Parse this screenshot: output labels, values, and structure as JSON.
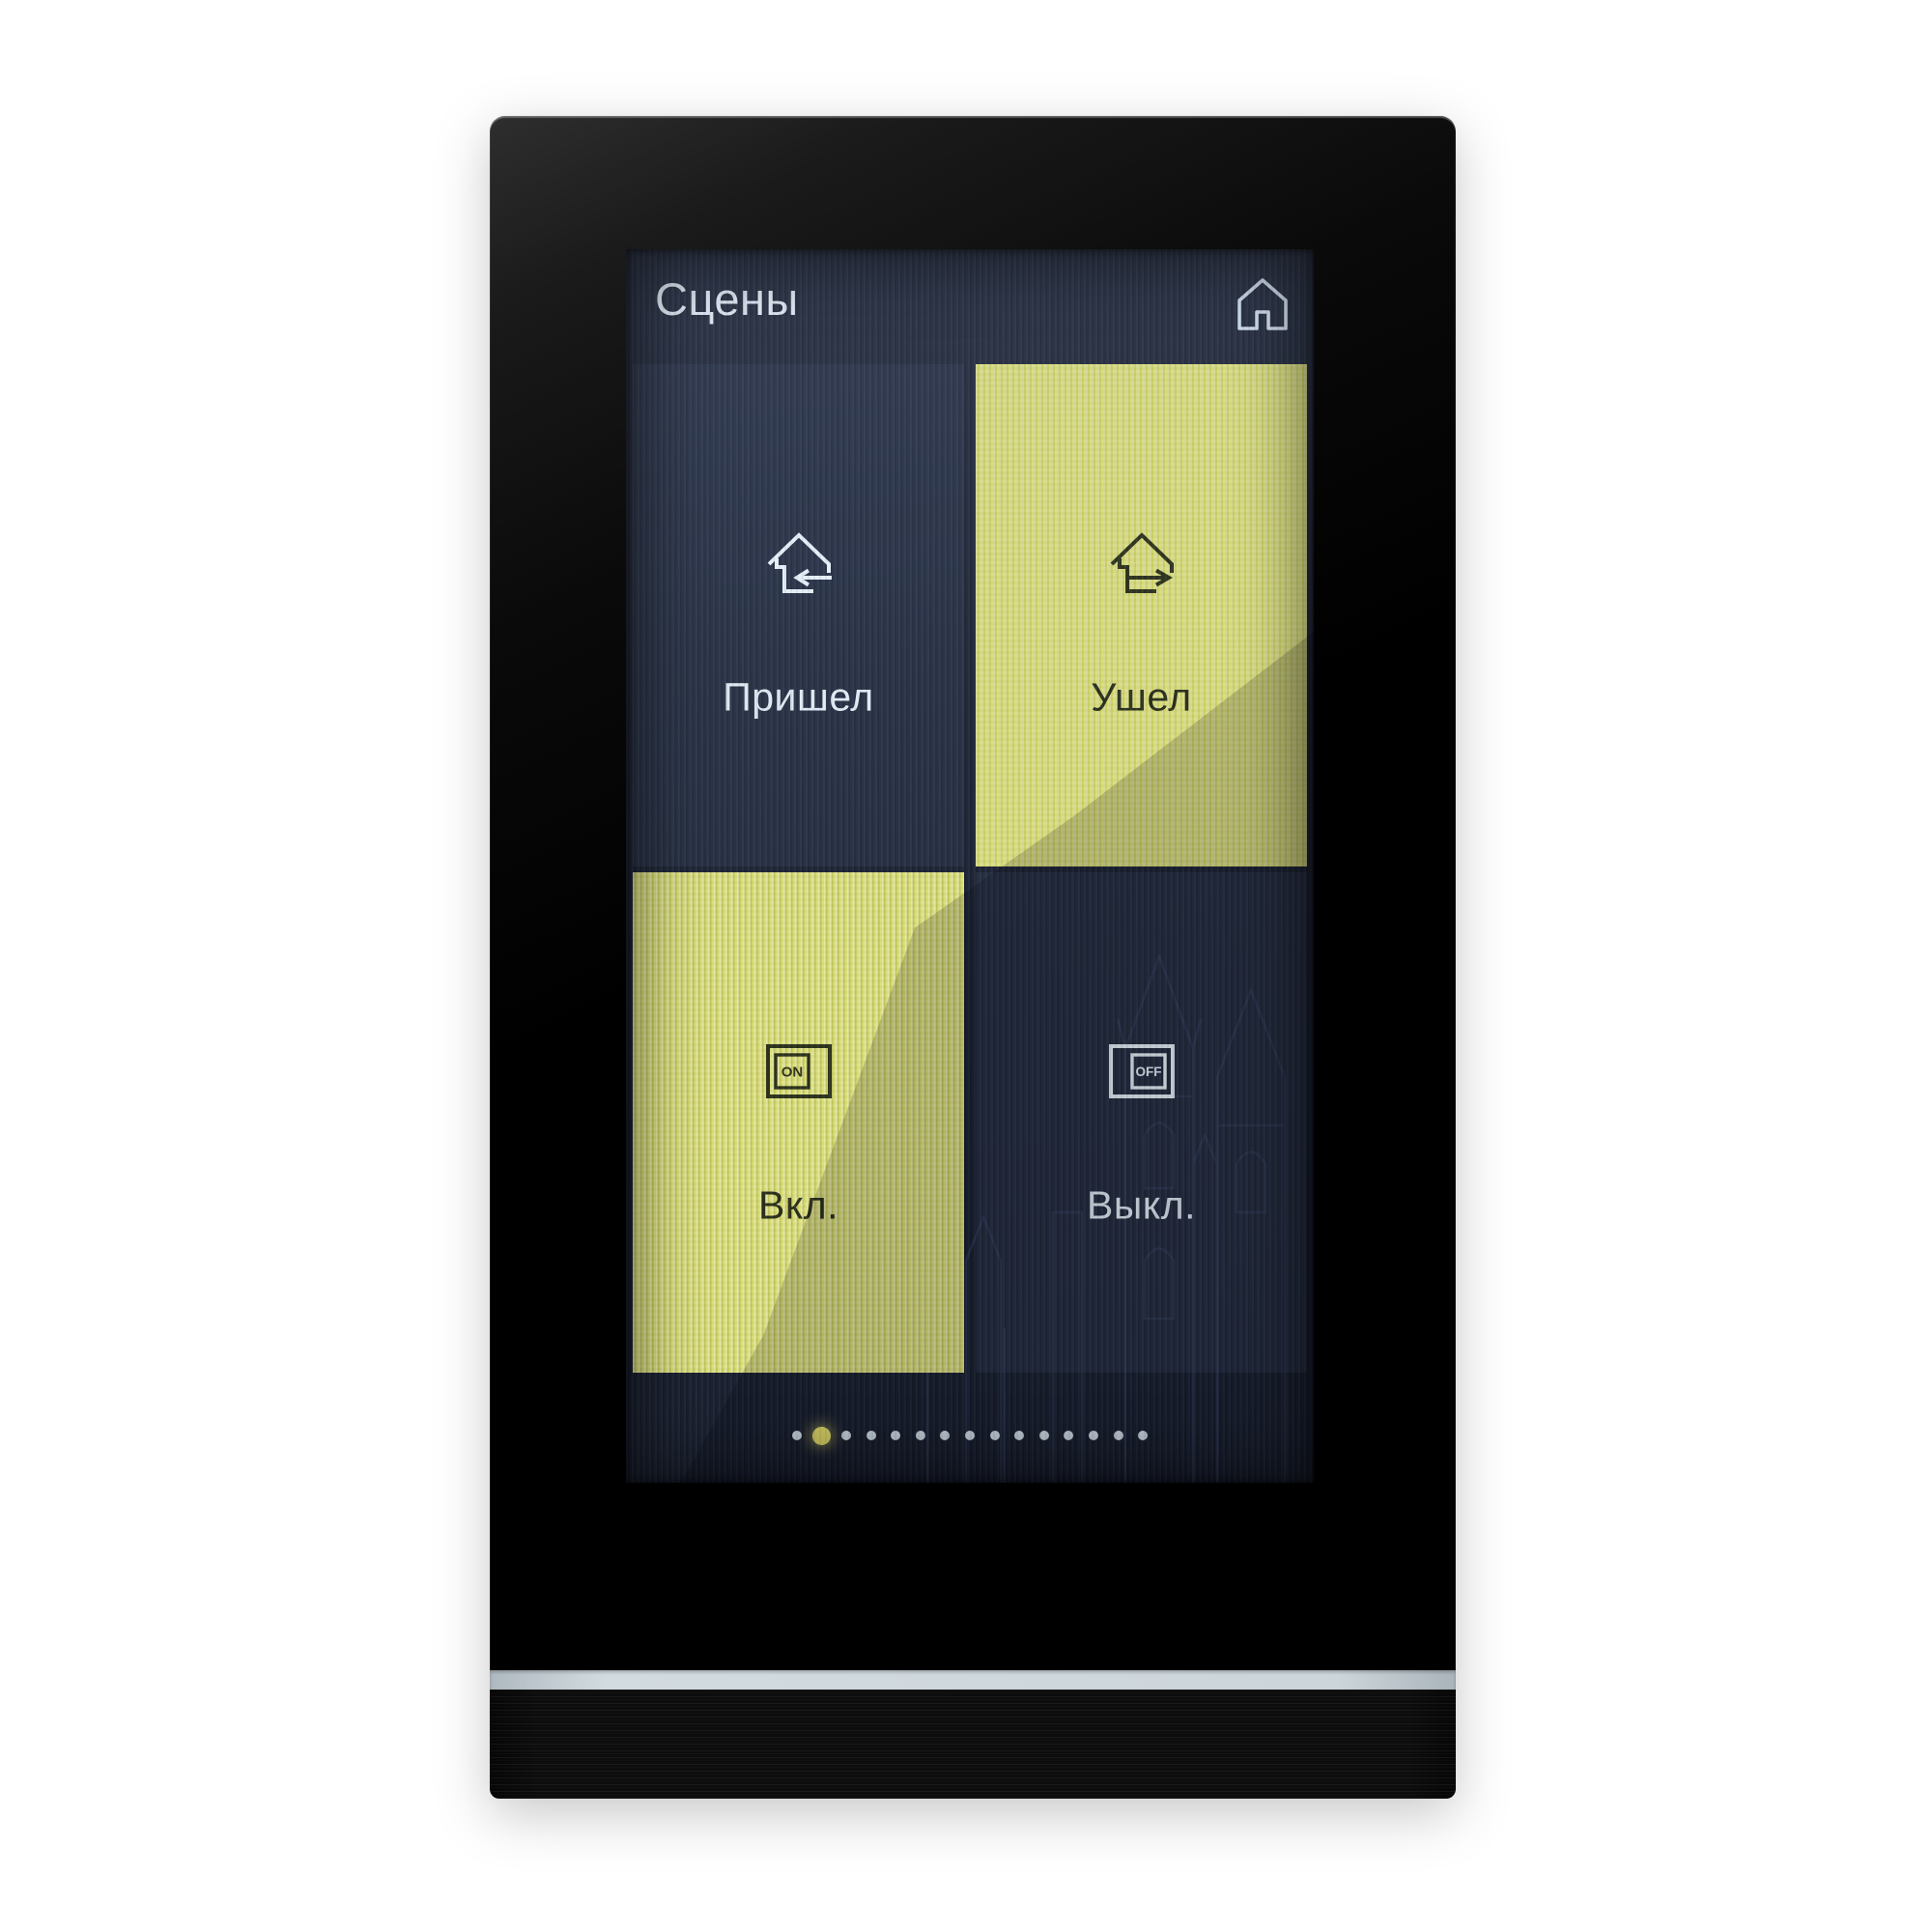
{
  "header": {
    "title": "Сцены"
  },
  "scenes": {
    "tiles": [
      {
        "label": "Пришел",
        "icon": "house-arrive-icon",
        "active": false
      },
      {
        "label": "Ушел",
        "icon": "house-leave-icon",
        "active": true
      },
      {
        "label": "Вкл.",
        "icon": "switch-on-icon",
        "active": true
      },
      {
        "label": "Выкл.",
        "icon": "switch-off-icon",
        "active": false
      }
    ]
  },
  "icons": {
    "home": "home-icon",
    "on_label": "ON",
    "off_label": "OFF"
  },
  "pagination": {
    "total_pages": 15,
    "active_index": 1
  },
  "colors": {
    "accent_yellow": "#d9dc6e",
    "text_light": "#e4edf5",
    "text_dark": "#272c18",
    "dot_inactive": "#d9e5ee",
    "dot_active": "#ebe468",
    "light_strip": "#ccd5da"
  }
}
